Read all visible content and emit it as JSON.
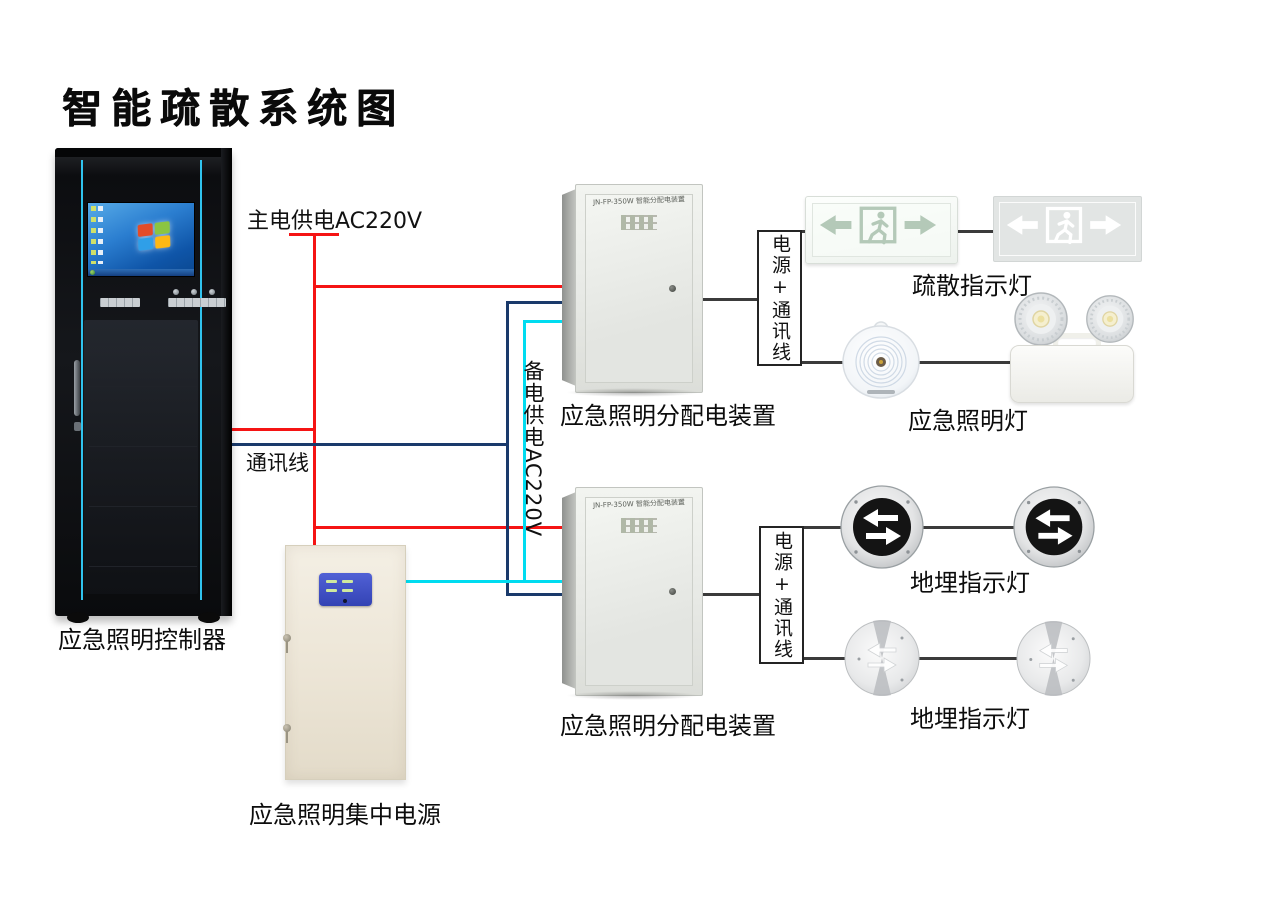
{
  "title": "智能疏散系统图",
  "colors": {
    "main_power": "#f51414",
    "comm": "#1a3a6b",
    "backup": "#00dcf0",
    "lamp_wire": "#3b3b3b"
  },
  "wire_labels": {
    "main_power": "主电供电AC220V",
    "comm": "通讯线",
    "backup_power": "备电供电AC220V",
    "power_comm_upper": "电源+通讯线",
    "power_comm_lower": "电源+通讯线"
  },
  "devices": {
    "controller": {
      "label": "应急照明控制器"
    },
    "central_power": {
      "label": "应急照明集中电源"
    },
    "distribution_upper": {
      "label": "应急照明分配电装置",
      "panel_text": "JN-FP-350W 智能分配电装置"
    },
    "distribution_lower": {
      "label": "应急照明分配电装置",
      "panel_text": "JN-FP-350W 智能分配电装置"
    },
    "exit_sign_group": {
      "label": "疏散指示灯"
    },
    "emergency_lamp_group": {
      "label": "应急照明灯"
    },
    "ground_lights_row1": {
      "label": "地埋指示灯"
    },
    "ground_lights_row2": {
      "label": "地埋指示灯"
    }
  }
}
